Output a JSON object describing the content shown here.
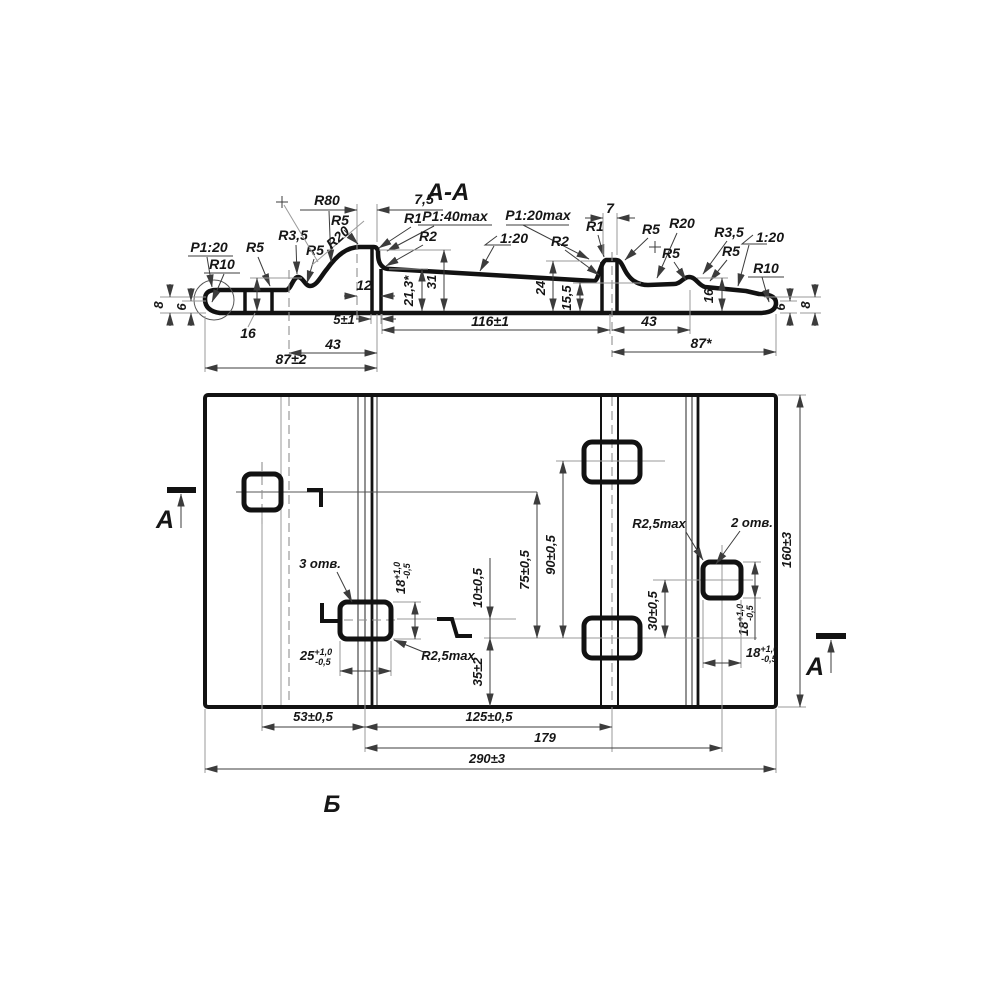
{
  "meta": {
    "background": "#ffffff",
    "ink_color": "#121212",
    "dim_color": "#3c3c3c",
    "centerline_color": "#8f8f8f"
  },
  "section": {
    "title": "A-A",
    "labels": {
      "slope_left": "P1:20",
      "slope_40max": "P1:40max",
      "slope_20max": "P1:20max",
      "slope_120": "1:20",
      "r10": "R10",
      "r5": "R5",
      "r35": "R3,5",
      "r80": "R80",
      "r20": "R20",
      "r1": "R1",
      "r2": "R2",
      "w_7_5": "7,5",
      "w_7": "7",
      "w_12": "12",
      "h_8": "8",
      "h_6": "6",
      "h_16": "16",
      "h_21_3": "21,3*",
      "h_31": "31",
      "h_24": "24",
      "h_15_5": "15,5",
      "d_5": "5±1",
      "d_116": "116±1",
      "d_43": "43",
      "d_87s": "87*",
      "d_87": "87±2"
    }
  },
  "plan": {
    "labels": {
      "marker_a": "А",
      "holes3": "3 отв.",
      "holes2": "2 отв.",
      "r25max": "R2,5max",
      "d10": "10±0,5",
      "d75": "75±0,5",
      "d90": "90±0,5",
      "d30": "30±0,5",
      "d35": "35±2",
      "d160": "160±3",
      "d53": "53±0,5",
      "d125": "125±0,5",
      "d179": "179",
      "d290": "290±3",
      "view_b": "Б"
    },
    "tol18": {
      "base": "18",
      "plus": "+1,0",
      "minus": "-0,5"
    },
    "tol25": {
      "base": "25",
      "plus": "+1,0",
      "minus": "-0,5"
    }
  }
}
